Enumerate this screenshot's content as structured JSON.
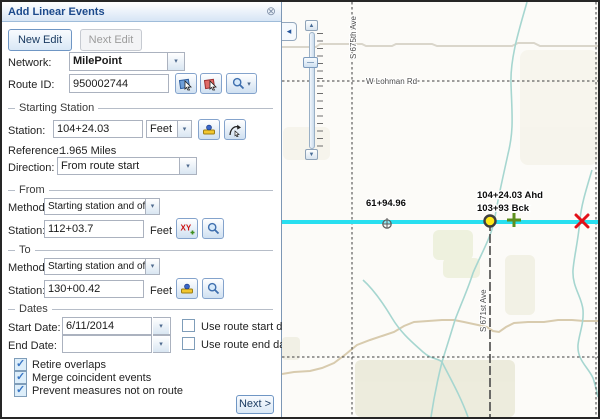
{
  "panel": {
    "title": "Add Linear Events",
    "toolbar": {
      "new_edit": "New Edit",
      "next_edit": "Next Edit"
    },
    "network": {
      "label": "Network:",
      "value": "MilePoint"
    },
    "route": {
      "label": "Route ID:",
      "value": "950002744"
    },
    "starting_station": {
      "legend": "Starting Station",
      "station": {
        "label": "Station:",
        "value": "104+24.03",
        "units": "Feet"
      },
      "reference": {
        "label": "Reference:",
        "value": "1.965 Miles"
      },
      "direction": {
        "label": "Direction:",
        "value": "From route start"
      }
    },
    "from": {
      "legend": "From",
      "method": {
        "label": "Method:",
        "value": "Starting station and offset"
      },
      "station": {
        "label": "Station:",
        "value": "112+03.7",
        "units": "Feet"
      }
    },
    "to": {
      "legend": "To",
      "method": {
        "label": "Method:",
        "value": "Starting station and offset"
      },
      "station": {
        "label": "Station:",
        "value": "130+00.42",
        "units": "Feet"
      }
    },
    "dates": {
      "legend": "Dates",
      "start": {
        "label": "Start Date:",
        "value": "6/11/2014",
        "checkbox_label": "Use route start date",
        "checked": false
      },
      "end": {
        "label": "End Date:",
        "value": "",
        "checkbox_label": "Use route end date",
        "checked": false
      }
    },
    "options": [
      {
        "label": "Retire overlaps",
        "checked": true
      },
      {
        "label": "Merge coincident events",
        "checked": true
      },
      {
        "label": "Prevent measures not on route",
        "checked": true
      }
    ],
    "next_button": "Next >"
  },
  "map": {
    "road_labels": {
      "lohman": "W Lohman Rd",
      "s675": "S 675th Ave",
      "s671": "S 671st Ave"
    },
    "measure_labels": {
      "station": "61+94.96",
      "ahead": "104+24.03 Ahd",
      "back": "103+93 Bck"
    },
    "colors": {
      "route_highlight": "#28dff0",
      "selected_point_fill": "#ffe818",
      "to_plus_marker": "#5d8f1e",
      "from_x_marker": "#e31018",
      "stream": "#a6d6d0"
    }
  },
  "icons": {
    "close": "⊗",
    "caret_down": "▾",
    "slider_up": "▲",
    "slider_down": "▼",
    "collapse_left": "◂",
    "check": "✓"
  }
}
